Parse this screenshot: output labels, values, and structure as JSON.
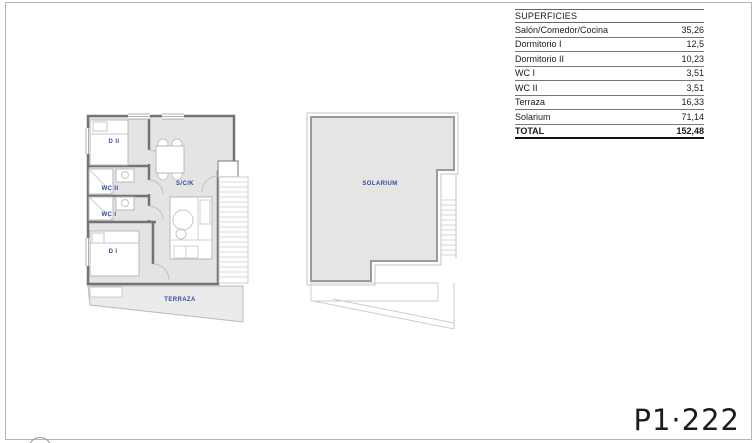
{
  "sheet": {
    "code": "P1·222"
  },
  "surfaces_table": {
    "title": "SUPERFICIES",
    "rows": [
      {
        "label": "Salón/Comedor/Cocina",
        "value": "35,26"
      },
      {
        "label": "Dormitorio I",
        "value": "12,5"
      },
      {
        "label": "Dormitorio II",
        "value": "10,23"
      },
      {
        "label": "WC I",
        "value": "3,51"
      },
      {
        "label": "WC II",
        "value": "3,51"
      },
      {
        "label": "Terraza",
        "value": "16,33"
      },
      {
        "label": "Solarium",
        "value": "71,14"
      }
    ],
    "total": {
      "label": "TOTAL",
      "value": "152,48"
    }
  },
  "floor_plan": {
    "labels": {
      "dormitorio2": "D II",
      "wc2": "WC II",
      "wc1": "WC I",
      "dormitorio1": "D I",
      "salon_comedor_cocina": "S/C/K",
      "terraza": "TERRAZA",
      "solarium": "SOLARIUM"
    }
  },
  "colors": {
    "label_blue": "#2b4f9e",
    "wall_gray": "#737373",
    "room_fill": "#e4e4e4",
    "solarium_fill": "#e5e6e3"
  }
}
